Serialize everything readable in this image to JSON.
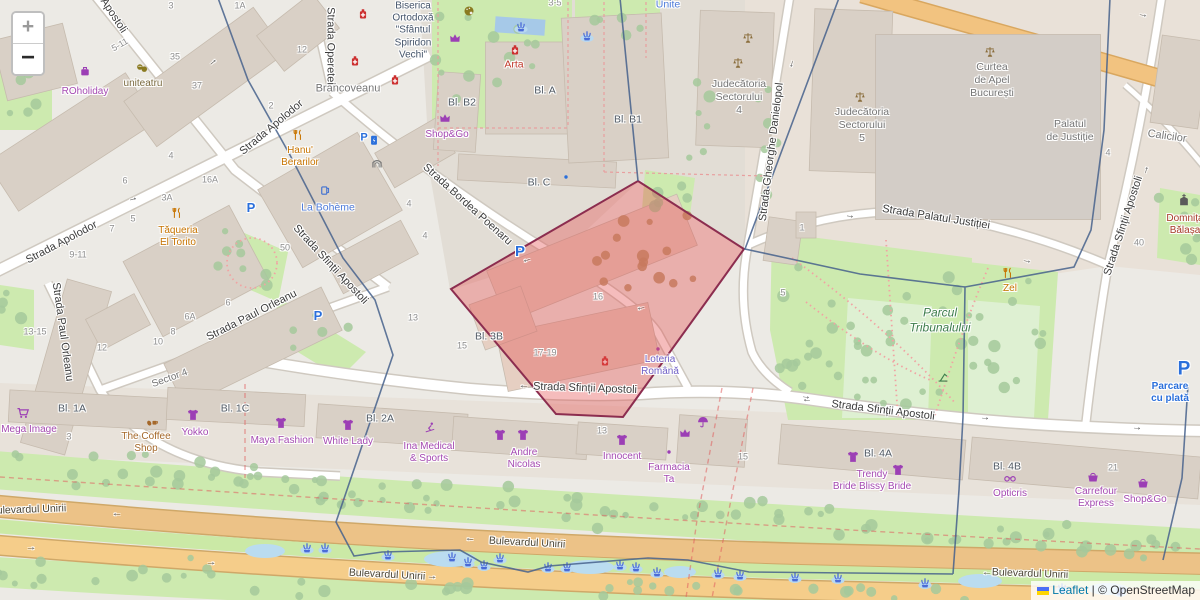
{
  "controls": {
    "zoom_in_label": "+",
    "zoom_out_label": "−"
  },
  "attribution": {
    "leaflet_label": "Leaflet",
    "separator": " | ",
    "copyright_label": "© OpenStreetMap"
  },
  "selection": {
    "fill": "#e05050",
    "stroke": "#8c2d4f"
  },
  "boundary_color": "#46618c",
  "labels": [
    [
      "Apostoli",
      113,
      16,
      "st",
      57
    ],
    [
      "Strada Apolodor",
      272,
      128,
      "st",
      -40
    ],
    [
      "Strada Apolodor",
      62,
      243,
      "st",
      -28
    ],
    [
      "Strada Operetei",
      330,
      46,
      "st",
      90
    ],
    [
      "Brancoveanu",
      348,
      89,
      "stg",
      0,
      11
    ],
    [
      "Strada Bordea Poenaru",
      467,
      205,
      "st",
      42
    ],
    [
      "Strada Sfinții Apostoli",
      330,
      265,
      "st",
      47
    ],
    [
      "Strada Paul Orleanu",
      62,
      332,
      "st",
      82
    ],
    [
      "Strada Paul Orleanu",
      252,
      316,
      "st",
      -27
    ],
    [
      "Sector 4",
      170,
      379,
      "stg",
      -20
    ],
    [
      "Strada Sfinții Apostoli",
      585,
      389,
      "st",
      2
    ],
    [
      "Strada Sfinții Apostoli",
      883,
      411,
      "st",
      7
    ],
    [
      "Strada Gheorghe Danielopol",
      772,
      152,
      "st",
      -83
    ],
    [
      "Strada Palatul Justiției",
      936,
      218,
      "st",
      9
    ],
    [
      "Strada Sfinții Apostoli",
      1124,
      226,
      "st",
      -72
    ],
    [
      "Calicilor",
      1167,
      137,
      "stg",
      8,
      11
    ],
    [
      "Unite",
      668,
      5,
      "wat",
      0
    ],
    [
      "Bulevardul Unirii",
      28,
      510,
      "road",
      -2
    ],
    [
      "Bulevardul Unirii",
      527,
      543,
      "road",
      3
    ],
    [
      "Bulevardul Unirii",
      387,
      575,
      "road",
      3
    ],
    [
      "Bulevardul Unirii",
      1030,
      574,
      "road",
      2
    ],
    [
      "←",
      117,
      514,
      "arw",
      0
    ],
    [
      "→",
      31,
      548,
      "arw",
      0
    ],
    [
      "→",
      211,
      563,
      "arw",
      0
    ],
    [
      "←",
      470,
      539,
      "arw",
      3
    ],
    [
      "→",
      432,
      577,
      "arw",
      3
    ],
    [
      "←",
      987,
      573,
      "arw",
      0
    ],
    [
      "←",
      524,
      386,
      "arw",
      0
    ],
    [
      "→",
      806,
      397,
      "arw",
      7
    ],
    [
      "→",
      213,
      62,
      "arw",
      -40
    ],
    [
      "→",
      133,
      199,
      "arw",
      -15
    ],
    [
      "←",
      527,
      260,
      "arw",
      -15
    ],
    [
      "←",
      641,
      308,
      "arw",
      -12
    ],
    [
      "→",
      850,
      216,
      "arw",
      8
    ],
    [
      "→",
      1027,
      261,
      "arw",
      12
    ],
    [
      "←",
      807,
      400,
      "arw",
      5
    ],
    [
      "→",
      985,
      418,
      "arw",
      5
    ],
    [
      "→",
      1137,
      428,
      "arw",
      5
    ],
    [
      "→",
      1143,
      15,
      "arw",
      12
    ],
    [
      "→",
      1146,
      170,
      "arw",
      -75
    ],
    [
      "→",
      792,
      64,
      "arw",
      105
    ],
    [
      "ROholiday",
      85,
      92,
      "shop"
    ],
    [
      "uniteatru",
      143,
      84,
      "thea"
    ],
    [
      "Biserica\nOrtodoxă\n\"Sfântul\nSpiridon\nVechi\"",
      413,
      31,
      "chu",
      0,
      10
    ],
    [
      "Arta",
      514,
      65,
      "pharm"
    ],
    [
      "Hanu'\nBerarilor",
      300,
      157,
      "rest"
    ],
    [
      "La Bohème",
      328,
      208,
      "wat"
    ],
    [
      "Tăqueria\nEl Torito",
      178,
      237,
      "rest"
    ],
    [
      "Shop&Go",
      447,
      135,
      "shop"
    ],
    [
      "Bl. B2",
      462,
      103,
      "blk"
    ],
    [
      "Bl. A",
      545,
      91,
      "blk"
    ],
    [
      "Bl. C",
      539,
      183,
      "blk"
    ],
    [
      "Bl. B1",
      628,
      120,
      "blk"
    ],
    [
      "Bl. 3B",
      489,
      337,
      "blk"
    ],
    [
      "Judecătoria\nSectorului\n4",
      739,
      97,
      "civ"
    ],
    [
      "Judecătoria\nSectorului\n5",
      862,
      125,
      "civ"
    ],
    [
      "Curtea\nde Apel\nBucurești",
      992,
      80,
      "civ"
    ],
    [
      "Palatul\nde Justiție",
      1070,
      131,
      "civ"
    ],
    [
      "Domnița\nBălașa",
      1185,
      225,
      "dom"
    ],
    [
      "Zel",
      1010,
      289,
      "rest"
    ],
    [
      "Parcul\nTribunalului",
      940,
      320,
      "park"
    ],
    [
      "Loteria\nRomână",
      660,
      366,
      "lot"
    ],
    [
      "Mega Image",
      29,
      430,
      "shop"
    ],
    [
      "The Coffee\nShop",
      146,
      443,
      "cafe"
    ],
    [
      "Yokko",
      195,
      433,
      "shop"
    ],
    [
      "Maya Fashion",
      282,
      441,
      "shop"
    ],
    [
      "White Lady",
      348,
      442,
      "shop"
    ],
    [
      "Bl. 1A",
      72,
      409,
      "blk"
    ],
    [
      "Bl. 1C",
      235,
      409,
      "blk"
    ],
    [
      "Bl. 2A",
      380,
      419,
      "blk"
    ],
    [
      "Ina Medical\n& Sports",
      429,
      453,
      "shop"
    ],
    [
      "Andre\nNicolas",
      524,
      459,
      "shop"
    ],
    [
      "Innocent",
      622,
      457,
      "shop"
    ],
    [
      "Farmacia\nTa",
      669,
      474,
      "shop"
    ],
    [
      "Trendy\nBride Blissy Bride",
      872,
      481,
      "shop"
    ],
    [
      "Bl. 4A",
      878,
      454,
      "blk"
    ],
    [
      "Bl. 4B",
      1007,
      467,
      "blk"
    ],
    [
      "Opticris",
      1010,
      494,
      "shop"
    ],
    [
      "Carrefour\nExpress",
      1096,
      498,
      "shop"
    ],
    [
      "Shop&Go",
      1145,
      500,
      "shop"
    ],
    [
      "Parcare\ncu plată",
      1170,
      393,
      "pk",
      0,
      10
    ],
    [
      "P",
      1184,
      369,
      "pk",
      0,
      19
    ],
    [
      "P",
      251,
      208,
      "pk",
      0,
      13
    ],
    [
      "P",
      318,
      316,
      "pk",
      0,
      13
    ],
    [
      "P",
      520,
      252,
      "pk",
      0,
      15
    ],
    [
      "P",
      364,
      138,
      "pk",
      0,
      11
    ],
    [
      "5-11",
      120,
      45,
      "num",
      -30
    ],
    [
      "3",
      171,
      6,
      "num"
    ],
    [
      "1A",
      240,
      6,
      "num"
    ],
    [
      "35",
      175,
      57,
      "num"
    ],
    [
      "37",
      197,
      86,
      "num"
    ],
    [
      "2",
      271,
      106,
      "num"
    ],
    [
      "12",
      302,
      50,
      "num"
    ],
    [
      "3-5",
      555,
      3,
      "num"
    ],
    [
      "16A",
      210,
      180,
      "num"
    ],
    [
      "3A",
      167,
      198,
      "num"
    ],
    [
      "4",
      171,
      156,
      "num"
    ],
    [
      "6",
      125,
      181,
      "num"
    ],
    [
      "5",
      133,
      219,
      "num"
    ],
    [
      "7",
      112,
      229,
      "num"
    ],
    [
      "9-11",
      78,
      255,
      "num"
    ],
    [
      "13-15",
      35,
      332,
      "num"
    ],
    [
      "12",
      102,
      348,
      "num"
    ],
    [
      "10",
      158,
      342,
      "num"
    ],
    [
      "8",
      173,
      332,
      "num"
    ],
    [
      "6A",
      190,
      317,
      "num"
    ],
    [
      "6",
      228,
      303,
      "num"
    ],
    [
      "50",
      285,
      248,
      "num"
    ],
    [
      "4",
      409,
      204,
      "num"
    ],
    [
      "4",
      425,
      236,
      "num"
    ],
    [
      "13",
      413,
      318,
      "num"
    ],
    [
      "15",
      462,
      346,
      "num"
    ],
    [
      "17-19",
      545,
      353,
      "num"
    ],
    [
      "16",
      598,
      297,
      "num"
    ],
    [
      "3",
      69,
      437,
      "num"
    ],
    [
      "13",
      602,
      431,
      "num"
    ],
    [
      "15",
      743,
      457,
      "num"
    ],
    [
      "21",
      1113,
      468,
      "num"
    ],
    [
      "40",
      1139,
      243,
      "num"
    ],
    [
      "1",
      802,
      228,
      "num"
    ],
    [
      "5",
      783,
      293,
      "num"
    ],
    [
      "4",
      1108,
      153,
      "num"
    ]
  ],
  "icons": [
    [
      "pharmacy",
      363,
      14
    ],
    [
      "pharmacy",
      355,
      61
    ],
    [
      "pharmacy",
      395,
      80
    ],
    [
      "pharmacy",
      515,
      50
    ],
    [
      "pharmacy",
      605,
      361
    ],
    [
      "palette",
      469,
      11
    ],
    [
      "masks",
      142,
      68
    ],
    [
      "luggage",
      85,
      71
    ],
    [
      "crown",
      455,
      38
    ],
    [
      "crown",
      445,
      118
    ],
    [
      "crown",
      685,
      433
    ],
    [
      "forkknife",
      177,
      213
    ],
    [
      "forkknife",
      298,
      135
    ],
    [
      "forkknife",
      1008,
      273
    ],
    [
      "beer",
      325,
      190
    ],
    [
      "cart",
      23,
      413
    ],
    [
      "coffee",
      152,
      421
    ],
    [
      "tshirt",
      193,
      415
    ],
    [
      "tshirt",
      281,
      423
    ],
    [
      "tshirt",
      348,
      425
    ],
    [
      "tshirt",
      500,
      435
    ],
    [
      "tshirt",
      523,
      435
    ],
    [
      "tshirt",
      622,
      440
    ],
    [
      "tshirt",
      853,
      457
    ],
    [
      "tshirt",
      898,
      470
    ],
    [
      "skier",
      430,
      428
    ],
    [
      "umbrella",
      703,
      422
    ],
    [
      "glasses",
      1010,
      478
    ],
    [
      "basket",
      1093,
      477
    ],
    [
      "basket",
      1143,
      483
    ],
    [
      "dot_purple",
      658,
      349
    ],
    [
      "dot_purple",
      669,
      452
    ],
    [
      "dot_blue",
      566,
      177
    ],
    [
      "scales",
      748,
      38
    ],
    [
      "scales",
      738,
      63
    ],
    [
      "scales",
      860,
      97
    ],
    [
      "scales",
      990,
      52
    ],
    [
      "church",
      1184,
      200
    ],
    [
      "gate",
      377,
      163
    ],
    [
      "playground",
      943,
      377
    ],
    [
      "charge",
      374,
      140
    ],
    [
      "fountain",
      521,
      27
    ],
    [
      "fountain",
      587,
      36
    ],
    [
      "fountain",
      307,
      548
    ],
    [
      "fountain",
      325,
      548
    ],
    [
      "fountain",
      388,
      555
    ],
    [
      "fountain",
      452,
      557
    ],
    [
      "fountain",
      468,
      562
    ],
    [
      "fountain",
      484,
      565
    ],
    [
      "fountain",
      500,
      558
    ],
    [
      "fountain",
      548,
      567
    ],
    [
      "fountain",
      567,
      567
    ],
    [
      "fountain",
      620,
      565
    ],
    [
      "fountain",
      636,
      567
    ],
    [
      "fountain",
      657,
      572
    ],
    [
      "fountain",
      718,
      573
    ],
    [
      "fountain",
      740,
      575
    ],
    [
      "fountain",
      795,
      577
    ],
    [
      "fountain",
      838,
      578
    ],
    [
      "fountain",
      925,
      583
    ],
    [
      "fountain",
      1062,
      588
    ],
    [
      "fountain",
      1120,
      591
    ]
  ]
}
